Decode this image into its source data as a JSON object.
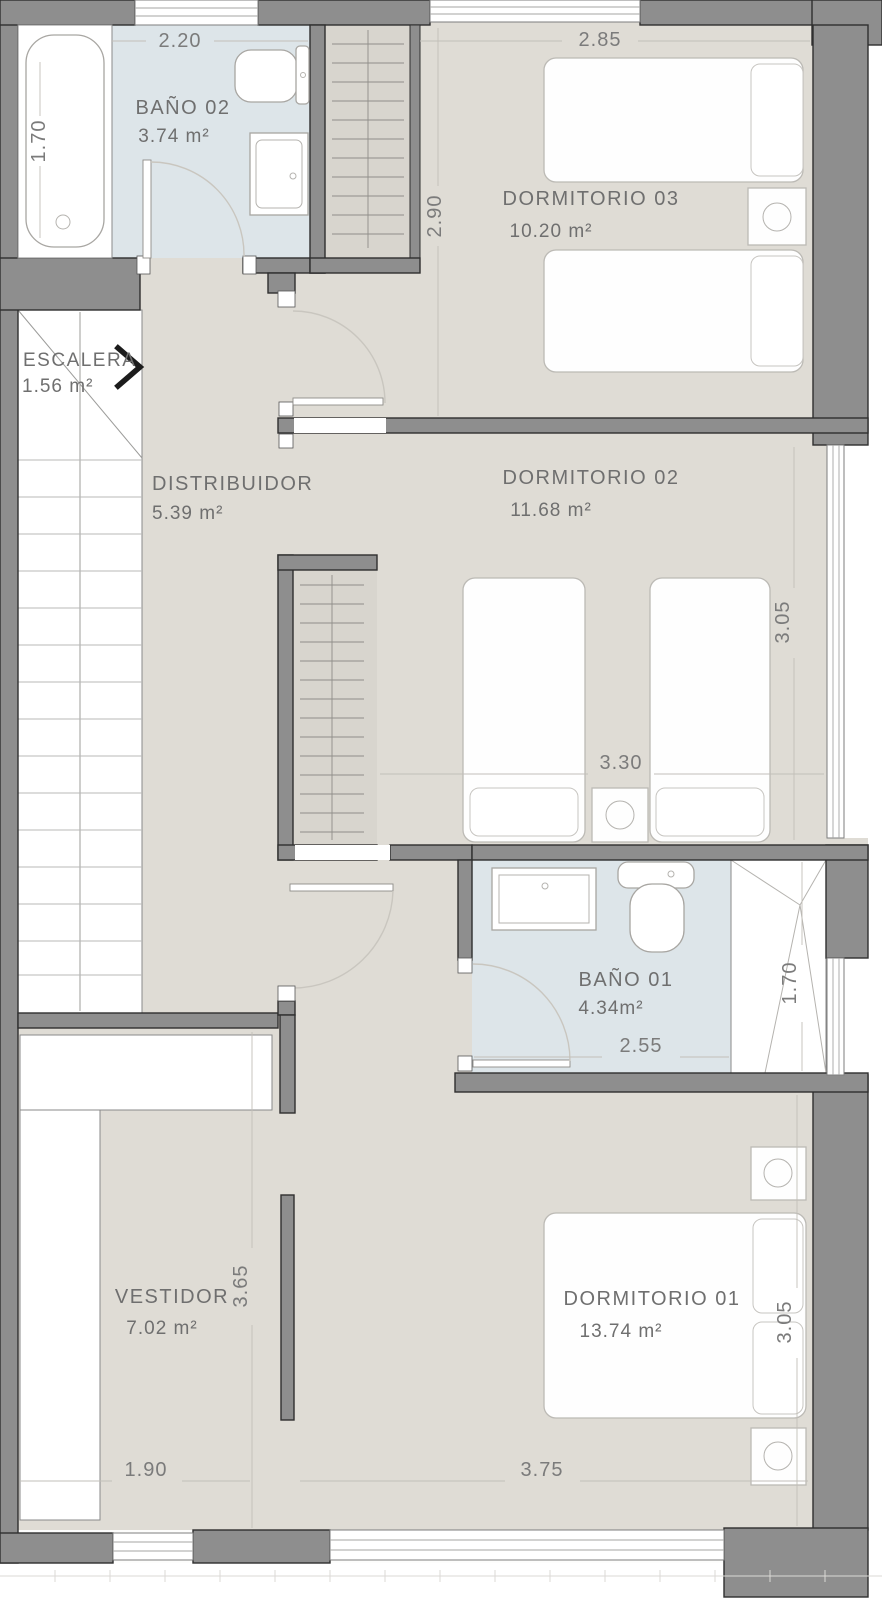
{
  "floor_plan": {
    "title": "Upper floor plan",
    "rooms": {
      "bano02": {
        "name": "BAÑO 02",
        "area": "3.74 m²"
      },
      "dormitorio03": {
        "name": "DORMITORIO 03",
        "area": "10.20 m²"
      },
      "escalera": {
        "name": "ESCALERA",
        "area": "1.56  m²"
      },
      "distribuidor": {
        "name": "DISTRIBUIDOR",
        "area": "5.39 m²"
      },
      "dormitorio02": {
        "name": "DORMITORIO 02",
        "area": "11.68 m²"
      },
      "bano01": {
        "name": "BAÑO 01",
        "area": "4.34m²"
      },
      "vestidor": {
        "name": "VESTIDOR",
        "area": "7.02 m²"
      },
      "dormitorio01": {
        "name": "DORMITORIO 01",
        "area": "13.74 m²"
      }
    },
    "dimensions": {
      "bano02_width": "2.20",
      "bano02_bath_depth": "1.70",
      "dormitorio03_width": "2.85",
      "dormitorio03_depth": "2.90",
      "dormitorio02_width": "3.30",
      "dormitorio02_depth": "3.05",
      "bano01_width": "2.55",
      "bano01_shower_depth": "1.70",
      "vestidor_depth": "3.65",
      "vestidor_width": "1.90",
      "dormitorio01_width": "3.75",
      "dormitorio01_depth": "3.05"
    },
    "colors": {
      "wall": "#8e8e8e",
      "floor": "#dfdcd5",
      "bathroom_floor": "#dde5e9",
      "closet_floor": "#d8d5ce",
      "furniture": "#ffffff",
      "label_text": "#6f6f6f"
    }
  }
}
